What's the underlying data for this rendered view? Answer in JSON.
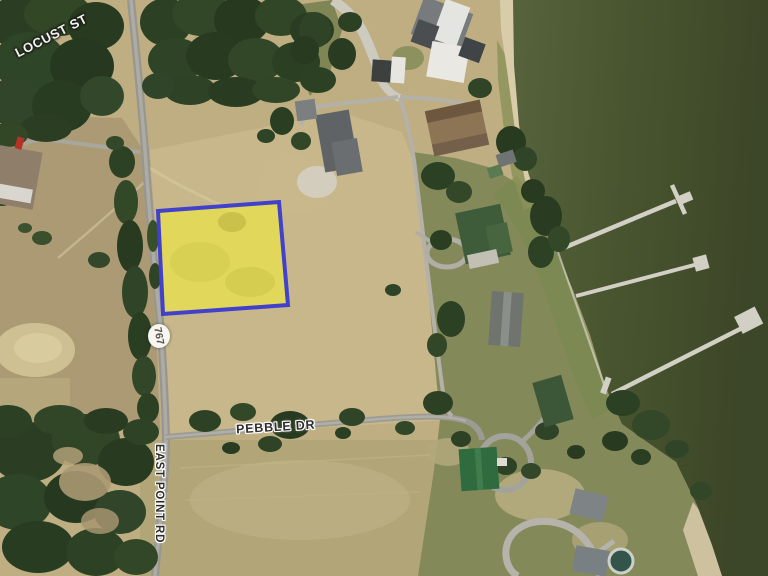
{
  "map": {
    "labels": {
      "locust_st": "LOCUST ST",
      "east_point_rd": "EAST POINT RD",
      "pebble_dr": "PEBBLE DR",
      "route_767": "767"
    },
    "highlighted_parcel": {
      "fill_color": "#e8e14b",
      "border_color": "#4141cc"
    },
    "colors": {
      "water": "#46522f",
      "field_tan": "#bfae82",
      "forest_green": "#2d4026",
      "road_gray": "#9d9d97",
      "dock_gray": "#d2cfc4"
    }
  }
}
